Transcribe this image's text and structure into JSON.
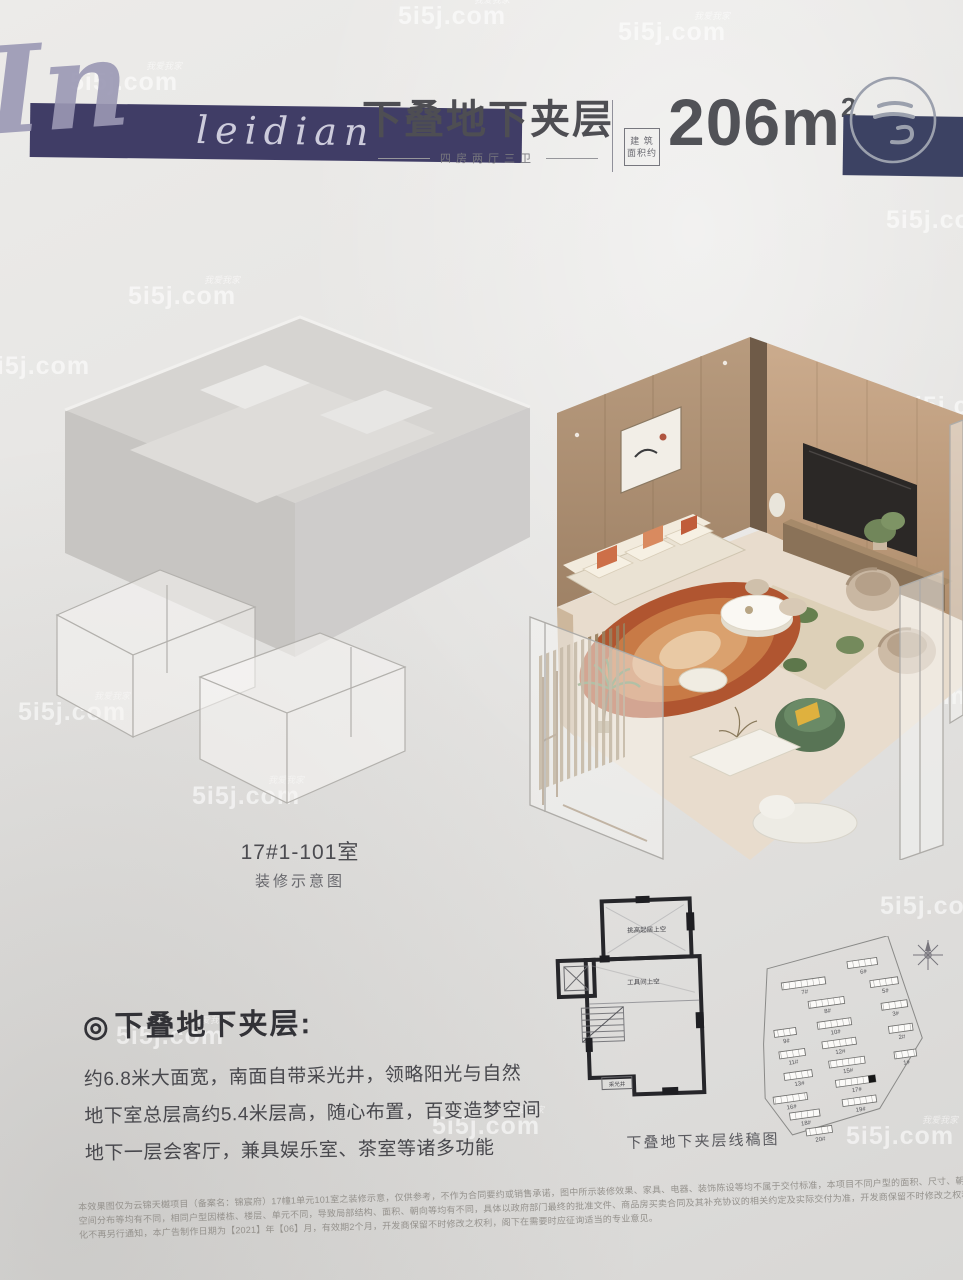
{
  "watermark": {
    "text": "5i5j.com",
    "prefix": "我爱我家"
  },
  "header": {
    "brand_initial": "In",
    "brand_script": "leidian",
    "title": "下叠地下夹层",
    "subtitle": "四房两厅三卫",
    "area_box_line1": "建 筑",
    "area_box_line2": "面积约",
    "area_value": "206m",
    "area_unit_sup": "2"
  },
  "render_label": {
    "unit": "17#1-101室",
    "caption": "装修示意图"
  },
  "feature": {
    "bullet": "◎",
    "heading": "下叠地下夹层:",
    "lines": [
      "约6.8米大面宽，南面自带采光井，领略阳光与自然",
      "地下室总层高约5.4米层高，随心布置，百变造梦空间",
      "地下一层会客厅，兼具娱乐室、茶室等诸多功能"
    ]
  },
  "line_plan": {
    "caption": "下叠地下夹层线稿图",
    "labels": {
      "room_upper": "挑高起居上空",
      "room_mid": "工具间上空",
      "light_well": "采光井"
    }
  },
  "site_plan": {
    "buildings": [
      "7#",
      "6#",
      "8#",
      "5#",
      "9#",
      "10#",
      "3#",
      "11#",
      "12#",
      "13#",
      "15#",
      "2#",
      "16#",
      "17#",
      "1#",
      "18#",
      "19#",
      "20#"
    ],
    "highlighted_building": "17#"
  },
  "disclaimer": {
    "lines": [
      "本效果图仅为云锦天樾项目（备案名：锦宸府）17幢1单元101室之装修示意，仅供参考，不作为合同要约或销售承诺，图中所示装修效果、家具、电器、装饰陈设等均不属于交付标准，本项目不同户型的面积、尺寸、朝向、功能布局、",
      "空间分布等均有不同，相同户型因楼栋、楼层、单元不同，导致局部结构、面积、朝向等均有不同，具体以政府部门最终的批准文件、商品房买卖合同及其补充协议的相关约定及实际交付为准，开发商保留不时修改之权利，如有变",
      "化不再另行通知，本广告制作日期为【2021】年【06】月，有效期2个月，开发商保留不时修改之权利，阁下在需要时应征询适当的专业意见。"
    ]
  }
}
